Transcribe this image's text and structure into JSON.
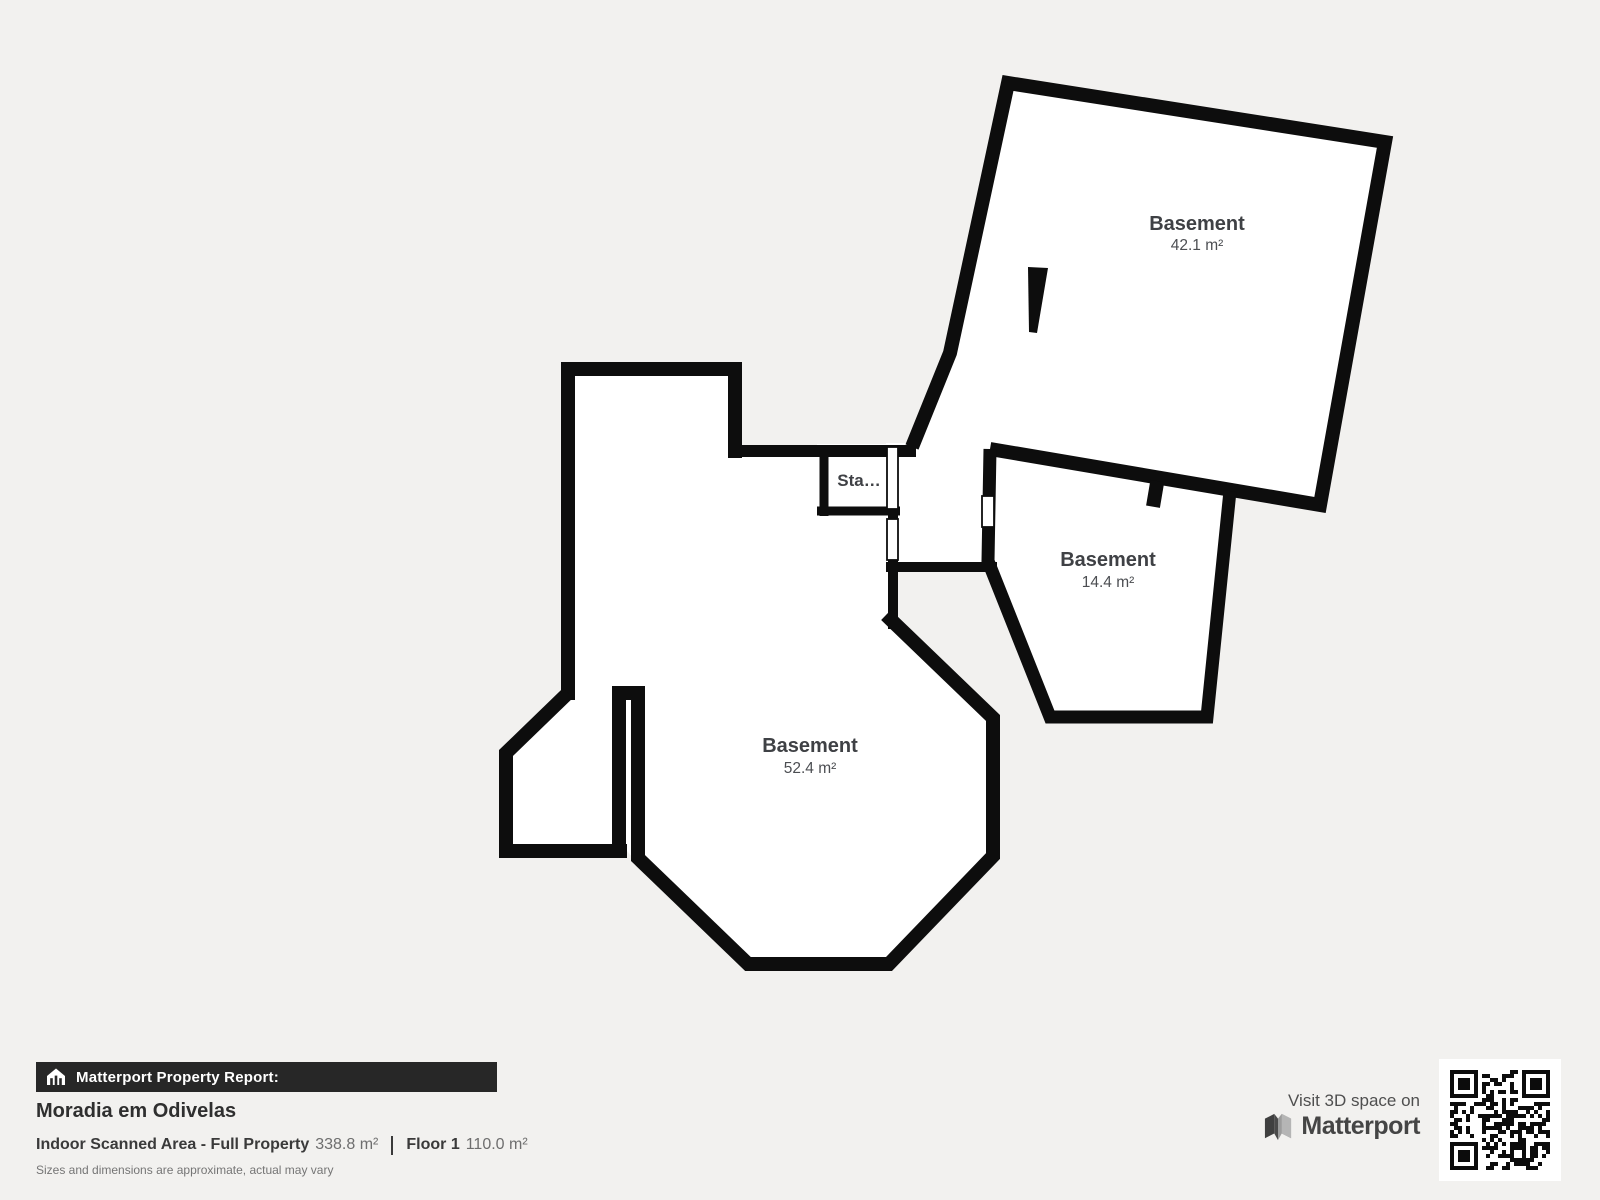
{
  "floorplan": {
    "rooms": [
      {
        "name": "Basement",
        "area": "42.1 m²"
      },
      {
        "name": "Basement",
        "area": "14.4 m²"
      },
      {
        "name": "Basement",
        "area": "52.4 m²"
      },
      {
        "name": "Sta…",
        "area": ""
      }
    ],
    "colors": {
      "background": "#f2f1ef",
      "wall": "#0d0d0d",
      "room_fill": "#ffffff"
    }
  },
  "footer": {
    "badge": "Matterport Property Report:",
    "property_name": "Moradia em Odivelas",
    "stat1_label": "Indoor Scanned Area - Full Property",
    "stat1_value": "338.8 m²",
    "stat2_label": "Floor 1",
    "stat2_value": "110.0 m²",
    "disclaimer": "Sizes and dimensions are approximate, actual may vary"
  },
  "cta": {
    "visit": "Visit 3D space on",
    "brand": "Matterport"
  }
}
